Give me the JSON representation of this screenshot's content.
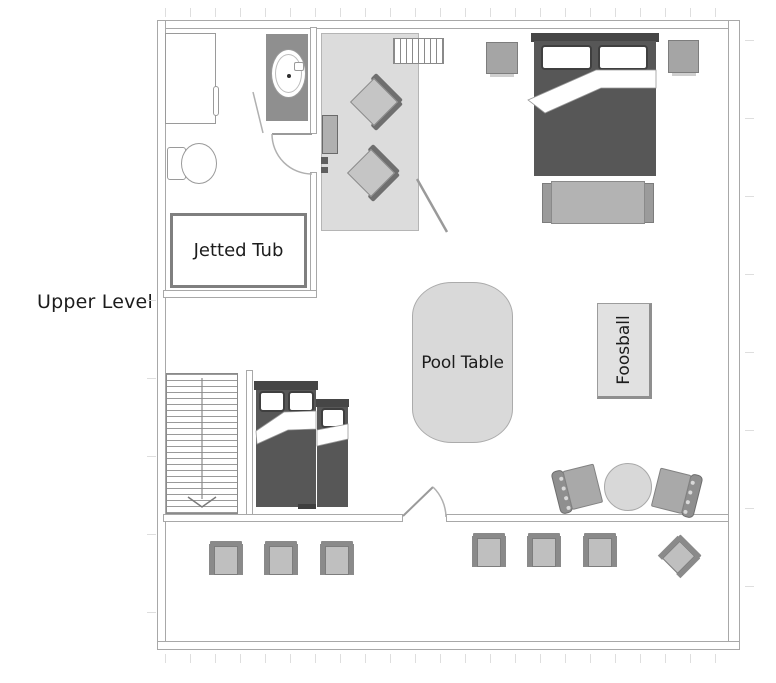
{
  "labels": {
    "level": "Upper Level",
    "jetted_tub": "Jetted Tub",
    "pool_table": "Pool Table",
    "foosball": "Foosball"
  },
  "colors": {
    "wall-line": "#a8a8a8",
    "furniture-dark": "#575757",
    "furniture-mid": "#a5a5a5",
    "furniture-light": "#c5c5c5",
    "accent-gray": "#8a8a8a",
    "fixture-border": "#9a9a9a",
    "rug": "#dcdcdc",
    "surface": "#d9d9d9",
    "tick": "#dedede",
    "text": "#1c1c1c"
  },
  "furniture_items": [
    "shower",
    "vanity-sink",
    "toilet",
    "jetted-tub",
    "area-rug",
    "lounge-chair",
    "console-table",
    "upper-staircase",
    "queen-bed",
    "nightstand",
    "bed-bench",
    "pool-table",
    "foosball-table",
    "main-staircase",
    "double-bed",
    "twin-bed",
    "round-table",
    "spindle-chair",
    "deck-chair",
    "swing-door"
  ]
}
